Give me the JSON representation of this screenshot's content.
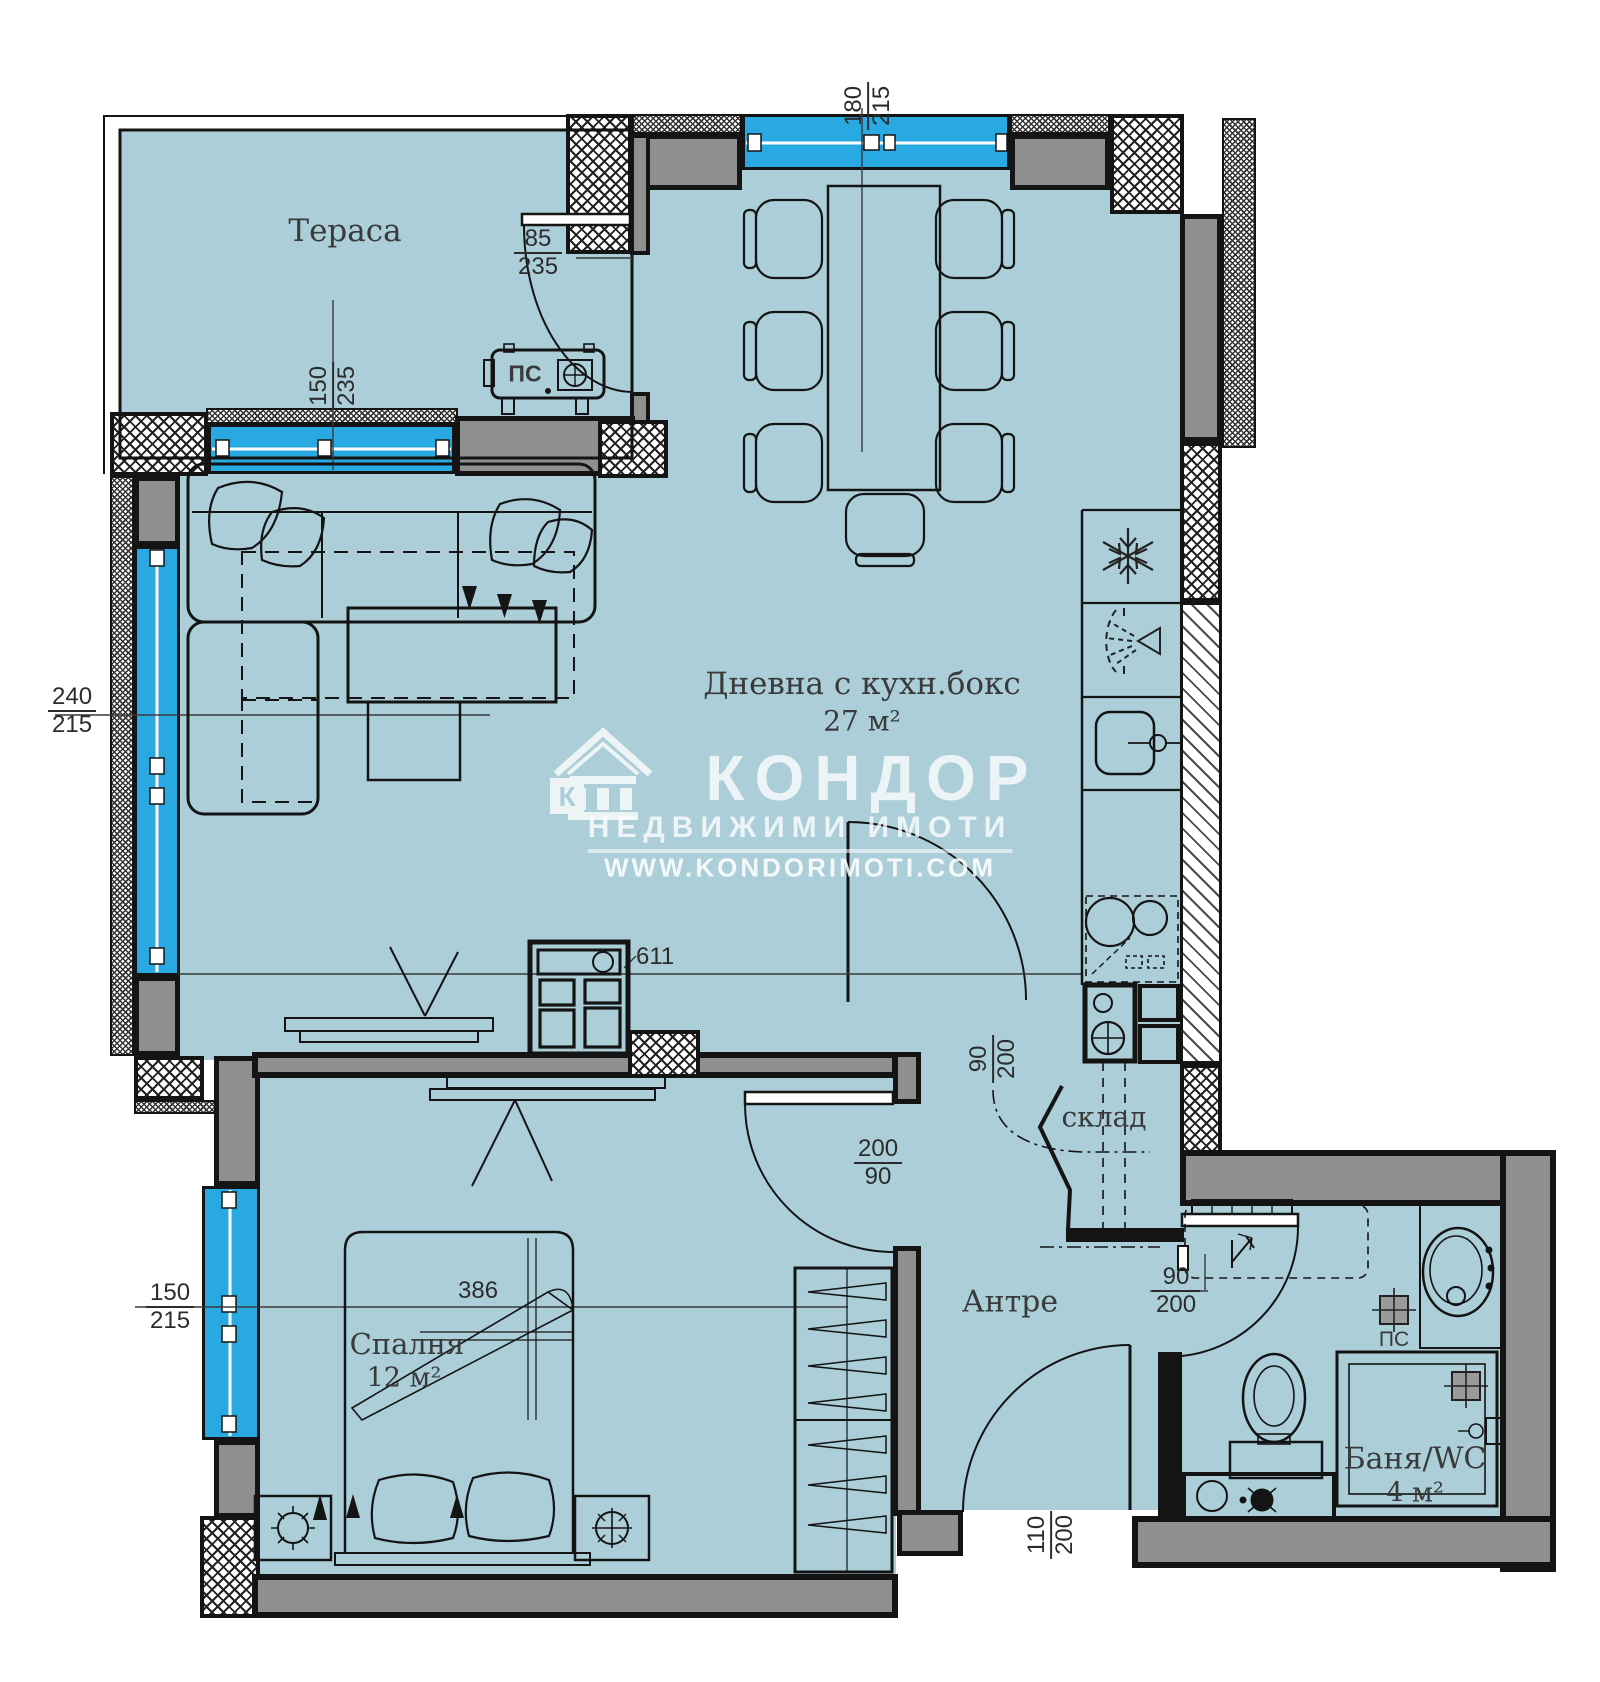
{
  "watermark": {
    "brand": "КОНДОР",
    "tagline": "НЕДВИЖИМИ ИМОТИ",
    "website": "WWW.KONDORIMOTI.COM",
    "logo_letter": "К"
  },
  "rooms": {
    "terrace": {
      "label": "Тераса"
    },
    "living": {
      "label": "Дневна с кухн.бокс",
      "area": "27 м²"
    },
    "bedroom": {
      "label": "Спалня",
      "area": "12 м²"
    },
    "hall": {
      "label": "Антре"
    },
    "storage": {
      "label": "склад"
    },
    "bathroom": {
      "label": "Баня/WC",
      "area": "4 м²"
    }
  },
  "equipment": {
    "terrace_unit_label": "ПС",
    "bathroom_unit_label": "ПС"
  },
  "dimensions": {
    "top_window": {
      "top": "180",
      "bottom": "215"
    },
    "terrace_door": {
      "top": "85",
      "bottom": "235"
    },
    "terrace_window": {
      "top": "150",
      "bottom": "235"
    },
    "living_window": {
      "top": "240",
      "bottom": "215"
    },
    "living_length": {
      "value": "611"
    },
    "kitchen_door": {
      "top": "90",
      "bottom": "200"
    },
    "bedroom_door": {
      "top": "200",
      "bottom": "90"
    },
    "bedroom_width": {
      "value": "386"
    },
    "bedroom_window": {
      "top": "150",
      "bottom": "215"
    },
    "bathroom_door": {
      "top": "90",
      "bottom": "200"
    },
    "entry_door": {
      "top": "110",
      "bottom": "200"
    }
  },
  "colors": {
    "floor": "#abced8",
    "window_glass": "#29a9e2",
    "wall_gray": "#8f8f8f",
    "outline": "#141414",
    "watermark": "#ffffff"
  }
}
